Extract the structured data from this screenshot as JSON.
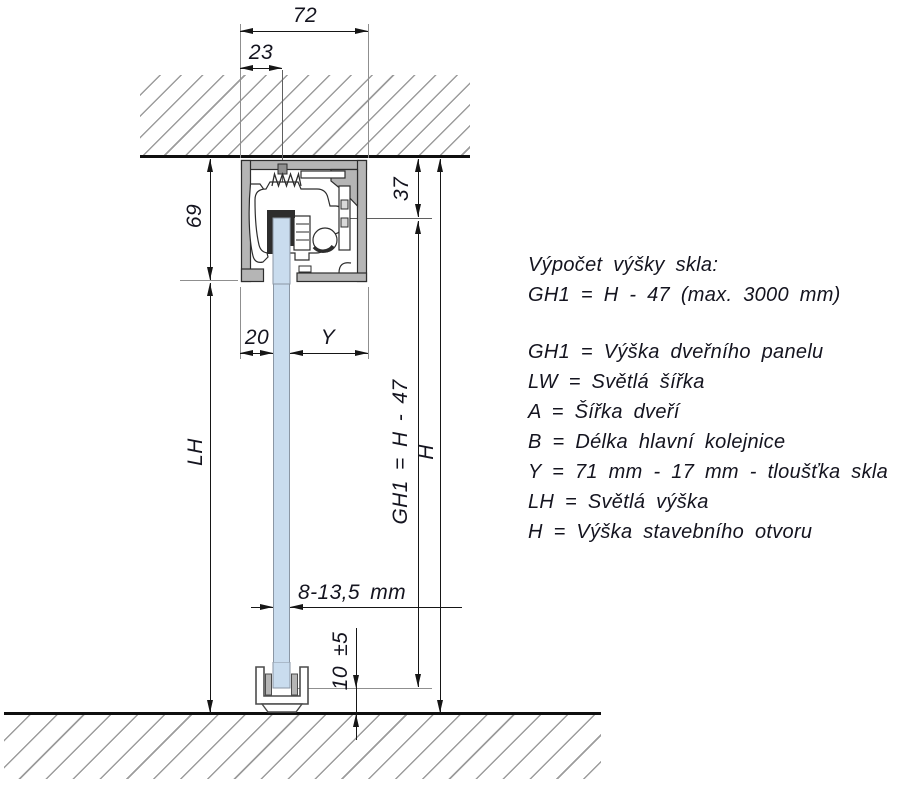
{
  "drawing": {
    "dims": {
      "track_width": "72",
      "bolt_offset": "23",
      "header_height": "69",
      "ceiling_to_glass_top": "37",
      "left_inset": "20",
      "right_inset": "Y",
      "clear_height": "LH",
      "panel_height": "GH1 = H - 47",
      "opening_height": "H",
      "glass_thickness": "8-13,5 mm",
      "floor_clearance": "10 ±5"
    },
    "legend": {
      "title": "Výpočet výšky skla:",
      "formula": "GH1 = H - 47 (max. 3000 mm)",
      "items": [
        "GH1 = Výška dveřního panelu",
        "LW = Světlá šířka",
        "A = Šířka dveří",
        "B = Délka hlavní kolejnice",
        "Y = 71 mm - 17 mm - tloušťka skla",
        "LH = Světlá výška",
        "H = Výška stavebního otvoru"
      ]
    },
    "colors": {
      "glass": "#c9dcee",
      "profile": "#b5b5b5",
      "line": "#161616",
      "hatch": "#9c9c9c",
      "text": "#14141f"
    }
  }
}
